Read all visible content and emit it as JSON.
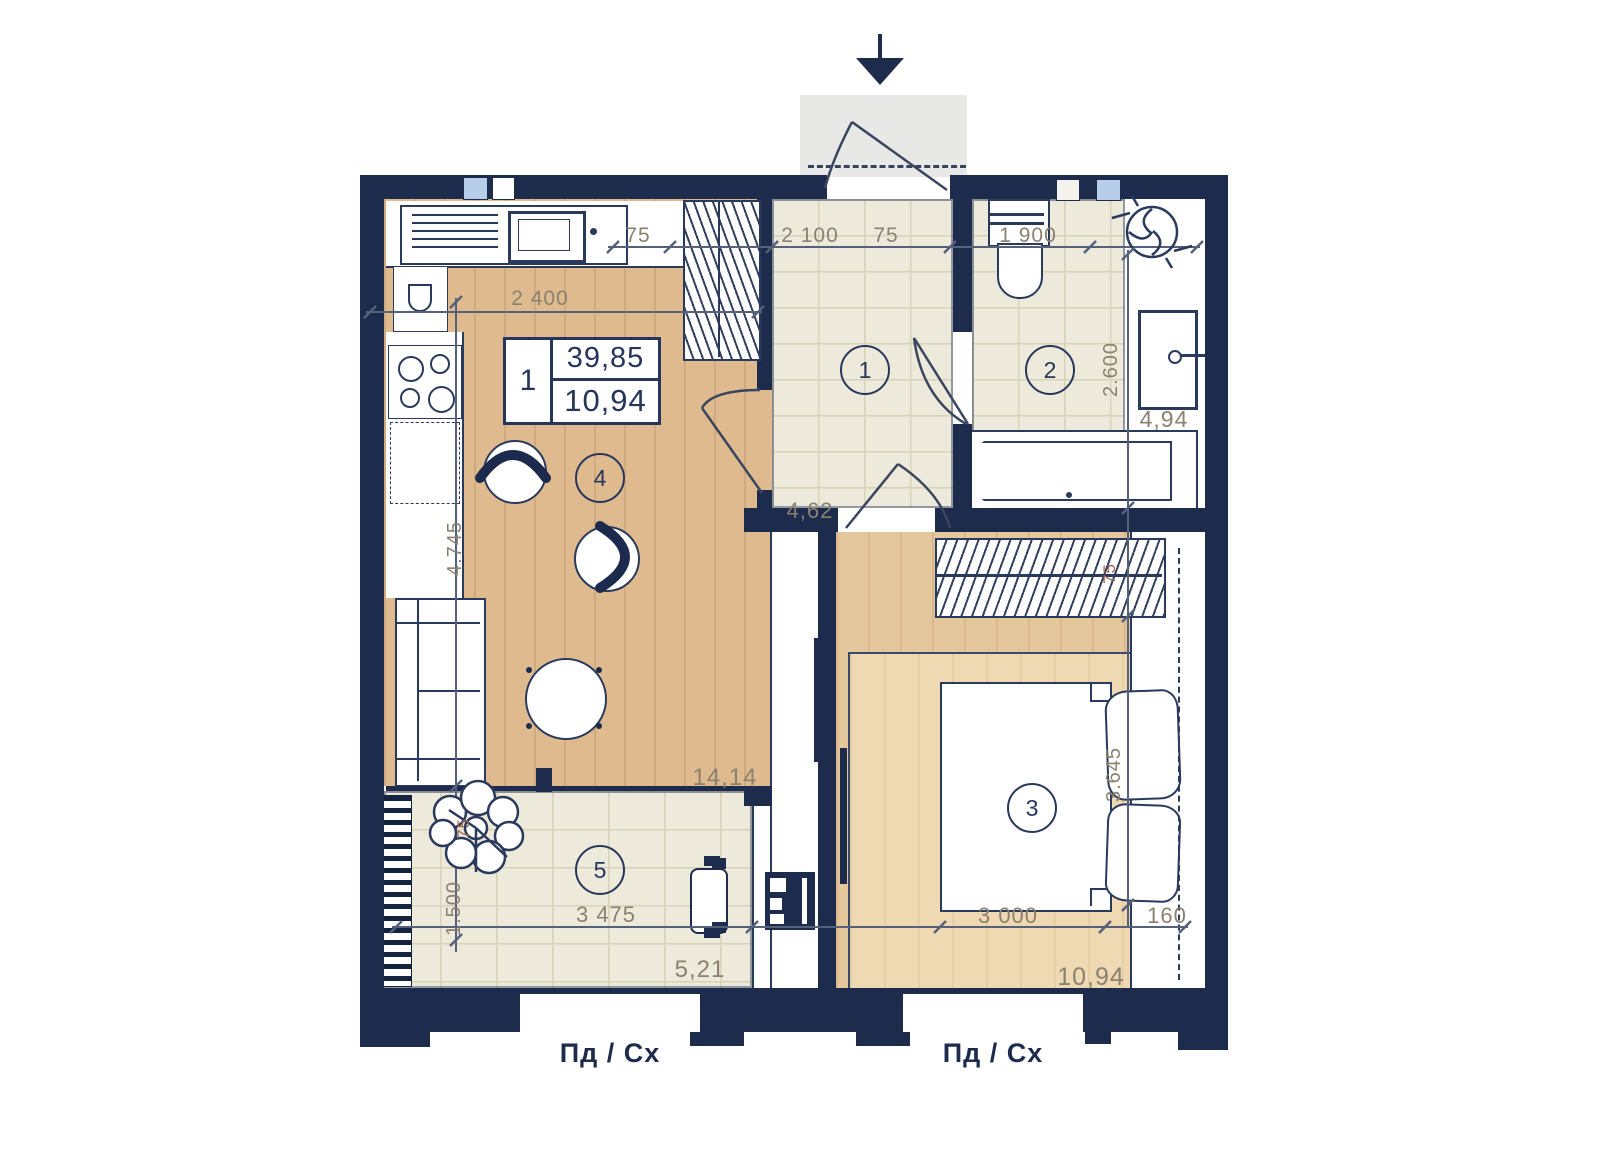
{
  "info_box": {
    "type": "1",
    "area_total": "39,85",
    "area_living": "10,94"
  },
  "rooms": {
    "hallway": {
      "number": "1",
      "area": "4,62"
    },
    "bathroom": {
      "number": "2",
      "area": "4,94",
      "height": "2.600"
    },
    "bedroom": {
      "number": "3",
      "area": "10,94",
      "bed_width": "3 000",
      "height": "3.645",
      "niche_width": "160",
      "wardrobe_depth": "75"
    },
    "kitchen_living": {
      "number": "4",
      "area": "14,14",
      "width": "2 400",
      "height": "4.745"
    },
    "balcony": {
      "number": "5",
      "area": "5,21",
      "width": "3 475",
      "height": "1.500",
      "ledge": "75"
    }
  },
  "dimensions_top": {
    "seg1": "75",
    "seg2": "2 100",
    "seg3": "75",
    "seg4": "1 900"
  },
  "compass": {
    "left": "Пд / Сх",
    "right": "Пд / Сх"
  },
  "colors": {
    "wall": "#1d2b4d",
    "wood": "#deba8e",
    "wood_light": "#eed9b2",
    "tile": "#edeadb",
    "vent_blue": "#b8cdea",
    "dim_text": "#8a8170",
    "dim_red": "#a06555"
  }
}
